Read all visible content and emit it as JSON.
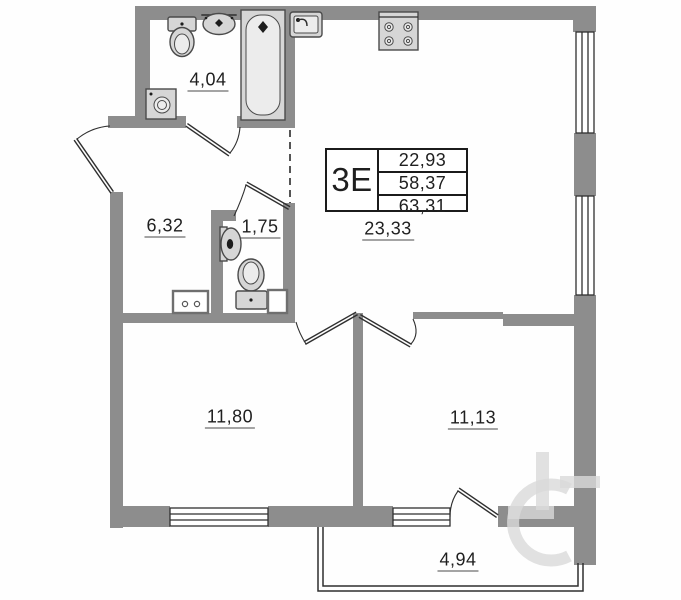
{
  "unit_card": {
    "unit_label": "3E",
    "stats": [
      "22,93",
      "58,37",
      "63,31"
    ]
  },
  "room_areas": {
    "bathroom": "4,04",
    "hallway": "6,32",
    "wc": "1,75",
    "kitchen_living": "23,33",
    "room_left": "11,80",
    "room_right": "11,13",
    "balcony": "4,94"
  },
  "icons": [
    "toilet-icon",
    "bathroom-sink-icon",
    "bathtub-icon",
    "washing-machine-icon",
    "kitchen-sink-icon",
    "stove-icon",
    "wc-sink-icon",
    "wc-toilet-icon",
    "door-swing-icon",
    "window-icon",
    "cabinet-icon",
    "vent-shaft-icon"
  ],
  "colors": {
    "wall": "#8d8d8d",
    "line": "#2f2f2f",
    "fixture_fill": "#d6d6d6",
    "text": "#1f1f1f",
    "watermark": "#d9d9d9",
    "background": "#fefefe"
  }
}
